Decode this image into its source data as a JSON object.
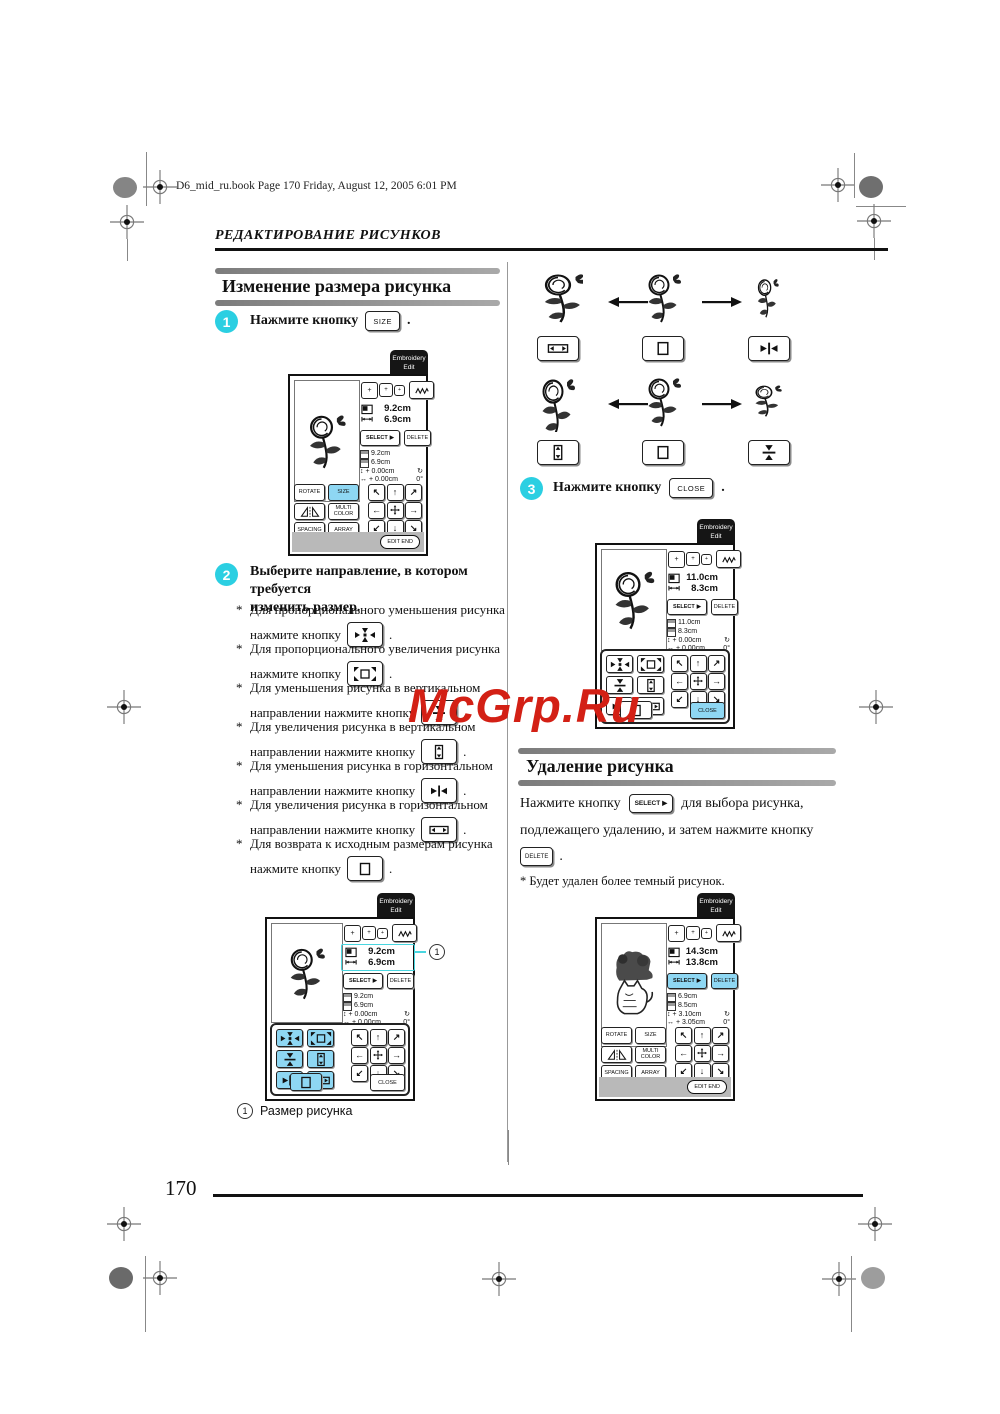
{
  "page": {
    "file_info": "D6_mid_ru.book  Page 170  Friday, August 12, 2005  6:01 PM",
    "chapter": "РЕДАКТИРОВАНИЕ РИСУНКОВ",
    "number": "170",
    "watermark": "McGrp.Ru"
  },
  "colors": {
    "step_cyan": "#2bcfe2",
    "button_blue": "#8ed7f3",
    "watermark_red": "#d32015",
    "section_bar_gray": "#8f8f8f"
  },
  "section_resize": {
    "title": "Изменение размера рисунка",
    "step1": {
      "num": "1",
      "text": "Нажмите кнопку",
      "button": "SIZE",
      "suffix": "."
    },
    "step2": {
      "num": "2",
      "line1": "Выберите направление, в котором требуется",
      "line2": "изменить размер."
    },
    "bullets": [
      {
        "star": "*",
        "line1": "Для пропорционального уменьшения рисунка",
        "line2": "нажмите кнопку",
        "icon": "shrink-proportional-icon",
        "suffix": "."
      },
      {
        "star": "*",
        "line1": "Для пропорционального увеличения рисунка",
        "line2": "нажмите кнопку",
        "icon": "enlarge-proportional-icon",
        "suffix": "."
      },
      {
        "star": "*",
        "line1": "Для уменьшения рисунка в вертикальном",
        "line2": "направлении нажмите кнопку",
        "icon": "shrink-vertical-icon",
        "suffix": "."
      },
      {
        "star": "*",
        "line1": "Для увеличения рисунка в вертикальном",
        "line2": "направлении нажмите кнопку",
        "icon": "stretch-vertical-icon",
        "suffix": "."
      },
      {
        "star": "*",
        "line1": "Для уменьшения рисунка в горизонтальном",
        "line2": "направлении нажмите кнопку",
        "icon": "shrink-horizontal-icon",
        "suffix": "."
      },
      {
        "star": "*",
        "line1": "Для увеличения рисунка в горизонтальном",
        "line2": "направлении нажмите кнопку",
        "icon": "stretch-horizontal-icon",
        "suffix": "."
      },
      {
        "star": "*",
        "line1": "Для возврата к исходным размерам рисунка",
        "line2": "нажмите кнопку",
        "icon": "reset-size-icon",
        "suffix": "."
      }
    ],
    "step3": {
      "num": "3",
      "text": "Нажмите кнопку",
      "button": "CLOSE",
      "suffix": "."
    },
    "callout": {
      "num": "1",
      "label": "Размер рисунка"
    }
  },
  "section_delete": {
    "title": "Удаление рисунка",
    "para_part1": "Нажмите кнопку",
    "para_button1": "SELECT",
    "para_part2": "для выбора рисунка,",
    "para_line2": "подлежащего удалению, и затем нажмите кнопку",
    "para_button2": "DELETE",
    "para_suffix": ".",
    "note": "*  Будет удален более темный рисунок."
  },
  "screens": {
    "tab_line1": "Embroidery",
    "tab_line2": "Edit",
    "hoop_plus": "+",
    "select_label": "SELECT",
    "select_arrow": "▶",
    "delete_label": "DELETE",
    "close_label": "CLOSE",
    "edit_end_label": "EDIT END",
    "rotate_label": "ROTATE",
    "size_label": "SIZE",
    "multi_line1": "MULTI",
    "multi_line2": "COLOR",
    "spacing_label": "SPACING",
    "array_label": "ARRAY",
    "v_icon": "↕",
    "h_icon": "↔",
    "rot_icon": "↻",
    "arrowpad": [
      "↖",
      "↑",
      "↗",
      "←",
      "→",
      "↙",
      "↓",
      "↘"
    ],
    "s1": {
      "w": "9.2cm",
      "h": "6.9cm",
      "sw": "9.2cm",
      "sh": "6.9cm",
      "dv": "+ 0.00cm",
      "dh": "+ 0.00cm",
      "angle": "0°"
    },
    "s2": {
      "w": "9.2cm",
      "h": "6.9cm",
      "sw": "9.2cm",
      "sh": "6.9cm",
      "dv": "+ 0.00cm",
      "dh": "+ 0.00cm",
      "angle": "0°"
    },
    "s3": {
      "w": "11.0cm",
      "h": "8.3cm",
      "sw": "11.0cm",
      "sh": "8.3cm",
      "dv": "+ 0.00cm",
      "dh": "+ 0.00cm",
      "angle": "0°"
    },
    "s4": {
      "w": "14.3cm",
      "h": "13.8cm",
      "sw": "6.9cm",
      "sh": "8.5cm",
      "dv": "+ 3.10cm",
      "dh": "+ 3.05cm",
      "angle": "0°"
    }
  }
}
